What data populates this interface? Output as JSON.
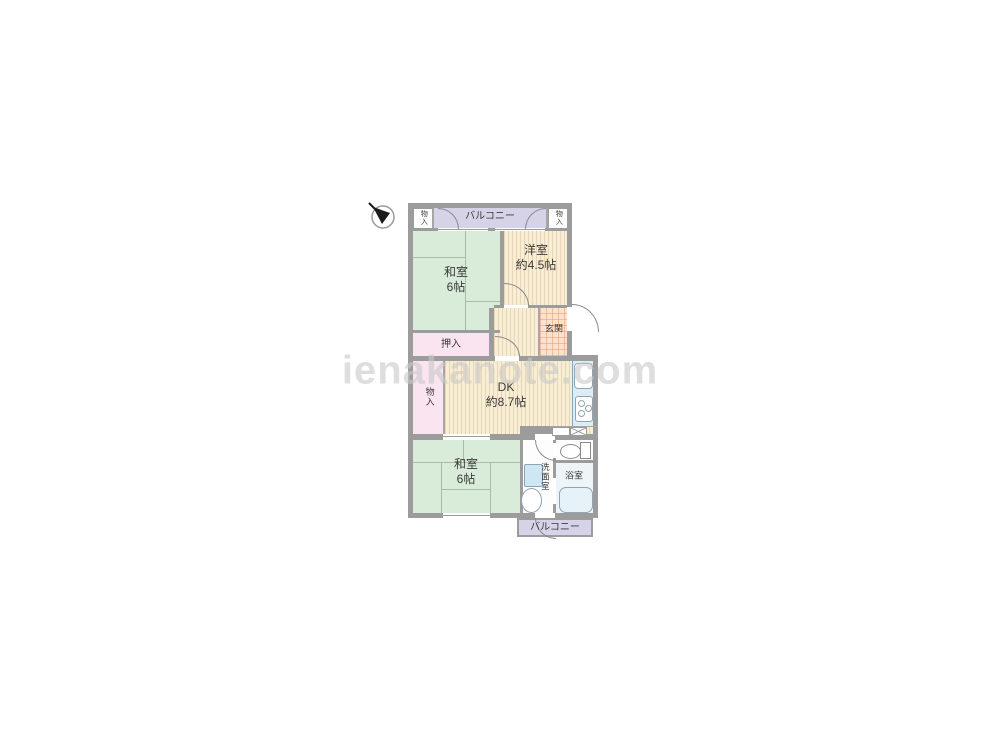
{
  "watermark": "ienakanote.com",
  "compass": {
    "icon": "north-arrow-icon",
    "direction": "upper-left"
  },
  "plan": {
    "rooms": {
      "balcony_top": {
        "label": "バルコニー"
      },
      "storage_top_left": {
        "label": "物入"
      },
      "storage_top_right": {
        "label": "物入"
      },
      "washitsu_top": {
        "label": "和室",
        "size": "6帖"
      },
      "youshitsu": {
        "label": "洋室",
        "size": "約4.5帖"
      },
      "genkan": {
        "label": "玄関"
      },
      "oshiire": {
        "label": "押入"
      },
      "storage_mid": {
        "label": "物入"
      },
      "dk": {
        "label": "DK",
        "size": "約8.7帖"
      },
      "washitsu_bottom": {
        "label": "和室",
        "size": "6帖"
      },
      "senmenshitsu": {
        "label": "洗面室"
      },
      "yokushitsu": {
        "label": "浴室"
      },
      "balcony_bottom": {
        "label": "バルコニー"
      }
    },
    "fixtures": [
      "kitchen-sink",
      "stove",
      "toilet",
      "washing-machine",
      "laundry-pan",
      "bathtub",
      "pipe-space"
    ],
    "colors": {
      "tatami": "#d9ecd9",
      "wood_floor": "#f8edd5",
      "closet": "#f9e4ef",
      "balcony": "#d6d3e8",
      "genkan": "#fbe2cd",
      "wall": "#9c9c9c",
      "fixture_blue": "#dcedf6",
      "watermark_gray": "#c9c9c9"
    }
  }
}
